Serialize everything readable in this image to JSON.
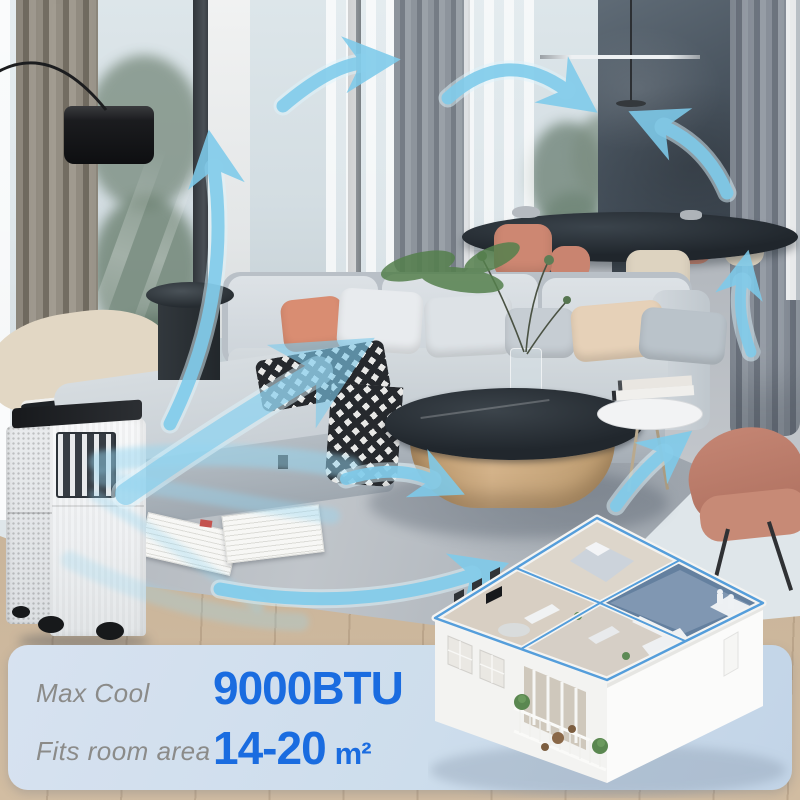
{
  "image_type": "product-lifestyle-image",
  "product": {
    "name_hint": "portable-air-conditioner"
  },
  "banner": {
    "specs": [
      {
        "label": "Max Cool",
        "value": "9000BTU",
        "unit": ""
      },
      {
        "label": "Fits room area",
        "value": "14-20",
        "unit": "m²"
      }
    ]
  },
  "colors": {
    "accent_blue": "#1a6ce0",
    "label_gray": "#8b8b89",
    "arrow_blue": "#7ecbeb",
    "banner_bg": "#cdddec"
  },
  "icons": {
    "airflow_arrow": "curved-blue-arrow",
    "floor_plan": "isometric-apartment-cutaway",
    "air_conditioner": "white-tower-ac-unit"
  }
}
